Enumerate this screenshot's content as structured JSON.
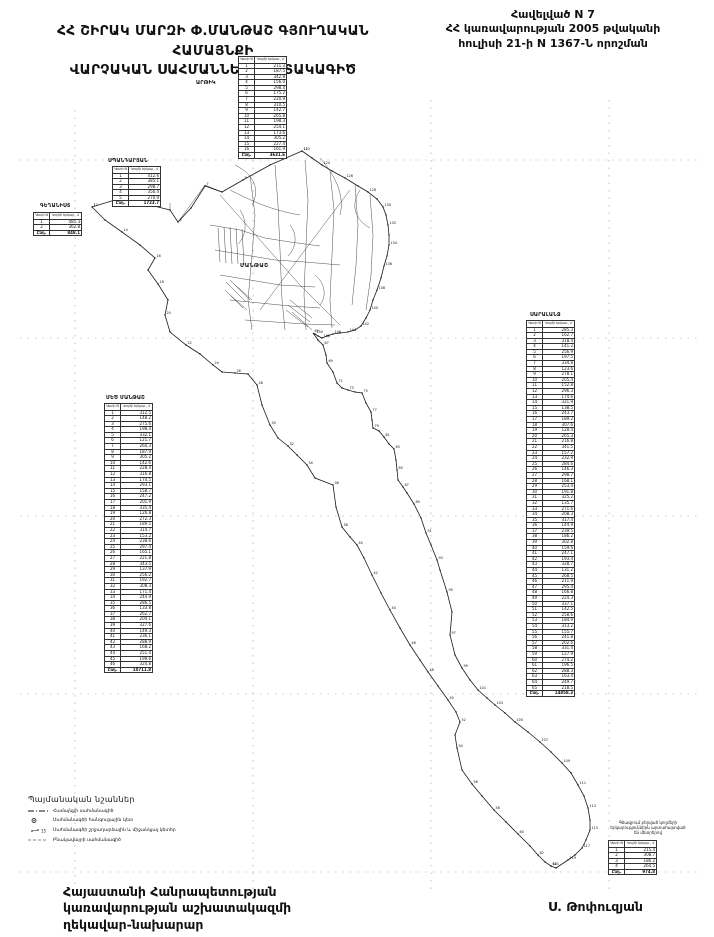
{
  "header": {
    "appendix_line1": "Հավելված N 7",
    "appendix_line2": "ՀՀ կառավարության 2005 թվականի",
    "appendix_line3": "հուլիսի 21-ի N 1367-Ն որոշման",
    "title_line1": "ՀՀ ՇԻՐԱԿ ՄԱՐԶԻ Փ.ՄԱՆԹԱՇ ԳՅՈՒՂԱԿԱՆ ՀԱՄԱՅՆՔԻ",
    "title_line2": "ՎԱՐՉԱԿԱՆ ՍԱՀՄԱՆՆԵՐԻ ՀԱՏԱԿԱԳԻԾ"
  },
  "map": {
    "village_label": "ՄԱՆԹԱՇ",
    "table_headers": {
      "col1": "Կետի N",
      "col2": "Կողմի երկար., մ"
    },
    "total_label": "Ընդ.",
    "tables": {
      "artik": {
        "label": "ԱՐԹԻԿ",
        "rows": [
          211.3,
          187.5,
          342.8,
          156.0,
          298.4,
          175.2,
          220.9,
          310.5,
          142.7,
          265.8,
          198.3,
          254.1,
          173.6,
          305.2,
          227.4,
          161.9
        ]
      },
      "spandaryan": {
        "label": "ՍՊԱՆԴԱՐՅԱՆ",
        "rows": [
          412.6,
          385.1,
          298.7,
          356.4,
          270.9
        ]
      },
      "geghanist": {
        "label": "ԳԵՂԱՆԻՍՏ",
        "rows": [
          485.3,
          362.8
        ]
      },
      "mets_mantash": {
        "label": "ՄԵԾ ՄԱՆԹԱՇ",
        "rows": [
          312.5,
          148.2,
          275.6,
          198.4,
          332.1,
          121.7,
          264.3,
          187.9,
          305.2,
          142.6,
          228.4,
          316.8,
          174.5,
          293.1,
          158.7,
          247.2,
          201.9,
          335.4,
          126.8,
          272.3,
          189.5,
          314.7,
          153.2,
          238.6,
          297.4,
          165.1,
          221.8,
          343.5,
          137.9,
          256.2,
          192.7,
          308.3,
          171.4,
          244.9,
          286.5,
          133.8,
          262.7,
          204.1,
          327.6,
          149.3,
          236.1,
          288.9,
          168.2,
          251.4,
          199.6,
          324.8
        ]
      },
      "saralanj": {
        "label": "ՍԱՐԱԼԱՆՋ",
        "rows": [
          285.3,
          162.7,
          318.4,
          141.2,
          256.9,
          197.5,
          334.8,
          123.6,
          278.1,
          205.4,
          152.8,
          296.3,
          174.6,
          321.9,
          138.5,
          243.7,
          189.2,
          307.6,
          128.4,
          265.3,
          216.8,
          341.5,
          157.2,
          232.9,
          284.6,
          146.3,
          298.7,
          168.1,
          253.4,
          191.8,
          325.2,
          135.7,
          271.6,
          208.3,
          317.4,
          144.9,
          239.5,
          186.2,
          302.8,
          159.6,
          247.1,
          193.4,
          328.7,
          131.2,
          268.5,
          211.9,
          295.4,
          166.8,
          224.3,
          337.1,
          142.5,
          258.6,
          184.9,
          313.2,
          155.7,
          241.8,
          202.6,
          331.4,
          127.9,
          274.2,
          196.5,
          288.3,
          163.4,
          249.7,
          218.5
        ]
      },
      "aragats": {
        "label": "",
        "rows": [
          215.4,
          308.7,
          186.2,
          264.5
        ]
      }
    },
    "note_box": {
      "line1": "Գծագրում բերված կողմերի",
      "line2": "երկարություններն արտահայտված",
      "line3": "են մետրերով"
    },
    "point_numbering": {
      "start": 1,
      "step": 2
    }
  },
  "legend": {
    "title": "Պայմանական նշաններ",
    "items": [
      {
        "label": "Համայնքի սահմանագիծ"
      },
      {
        "label": "Սահմանագծի հանգուցային կետ"
      },
      {
        "label": "Սահմանագծի շրջադարձային և միջանկյալ կետեր"
      },
      {
        "label": "Բնակավայրի սահմանագիծ"
      }
    ]
  },
  "footer": {
    "office_line1": "Հայաստանի Հանրապետության",
    "office_line2": "կառավարության աշխատակազմի",
    "office_line3": "ղեկավար-նախարար",
    "signature": "Ս. Թոփուզյան"
  }
}
